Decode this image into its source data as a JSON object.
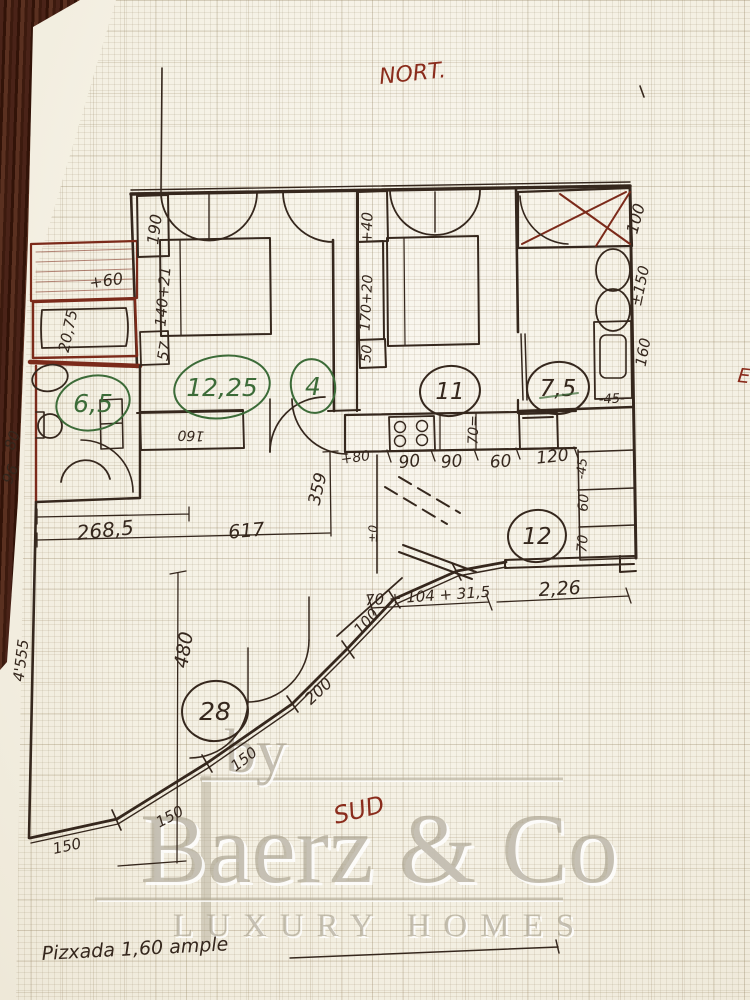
{
  "page": {
    "compass_north": "NORT.",
    "compass_east": "E",
    "compass_south": "SUD",
    "footer_note": "Pizxada 1,60 ample"
  },
  "areas": {
    "bath_left": "6,5",
    "bedroom_left": "12,25",
    "hall": "4",
    "bedroom_right": "11",
    "bath_right": "7,5",
    "kitchen": "12",
    "living": "28"
  },
  "dims": {
    "wardrobe_left": "190",
    "bed_left": "140+21",
    "nightstand_left": "57",
    "terrace_offset": "+60",
    "left_edge_a": "20,75",
    "left_edge_b": "80",
    "left_edge_c": "96",
    "left_wall_total": "4'555",
    "wardrobe_right_a": "+40",
    "wardrobe_right_b": "170+20",
    "wardrobe_right_c": "50",
    "bath_wall_a": "100",
    "bath_wall_b": "±150",
    "bath_wall_c": "160",
    "bath_closet": "-45-",
    "hall_cabinet": "160",
    "counter_offset": "+80",
    "counter_a": "90",
    "counter_b": "90",
    "counter_c": "60",
    "counter_d": "120",
    "counter_depth": "70=",
    "shelf_a": "-45",
    "shelf_b": "60",
    "shelf_c": "70",
    "level_mark": "±0",
    "hall_depth": "359",
    "corridor_width": "268,5",
    "plan_width": "617",
    "living_height": "480",
    "terrace_run": "70 + 104 + 31,5",
    "window_width": "2,26",
    "curve_s1": "150",
    "curve_s2": "150",
    "curve_s3": "150",
    "curve_s4": "200",
    "curve_s5": "100"
  },
  "watermark": {
    "by": "by",
    "brand": "Baerz & Co",
    "tagline": "LUXURY HOMES"
  },
  "colors": {
    "ink": "#35271d",
    "red_ink": "#7b2a1a",
    "green_ink": "#3c6b38",
    "watermark_gray": "#a59d8a",
    "paper": "#f6f3e9",
    "wood_edge": "#4a2318"
  }
}
